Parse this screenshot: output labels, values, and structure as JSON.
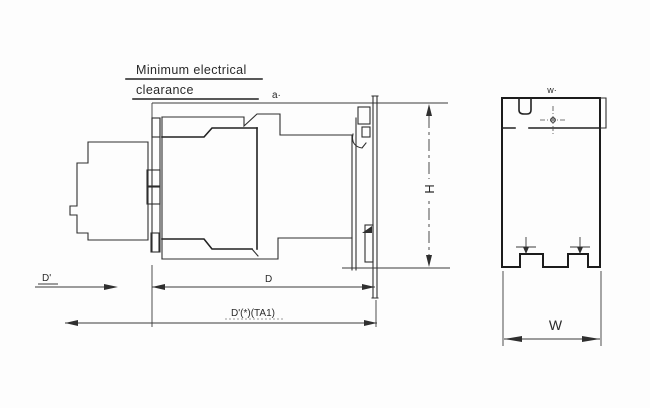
{
  "drawing": {
    "note": {
      "line1": "Minimum electrical",
      "line2": "clearance"
    },
    "labels": {
      "a": "a·",
      "H": "H",
      "w_top": "w·",
      "W": "W",
      "D_front": "D'",
      "D": "D",
      "D_total": "D'(*)(TA1)"
    },
    "views": {
      "left": "side-view-with-mounting-plate",
      "right": "front-view"
    },
    "colors": {
      "line": "#2f2f2f",
      "line_bold": "#1c1c1c",
      "background": "#fdfdfd"
    }
  }
}
